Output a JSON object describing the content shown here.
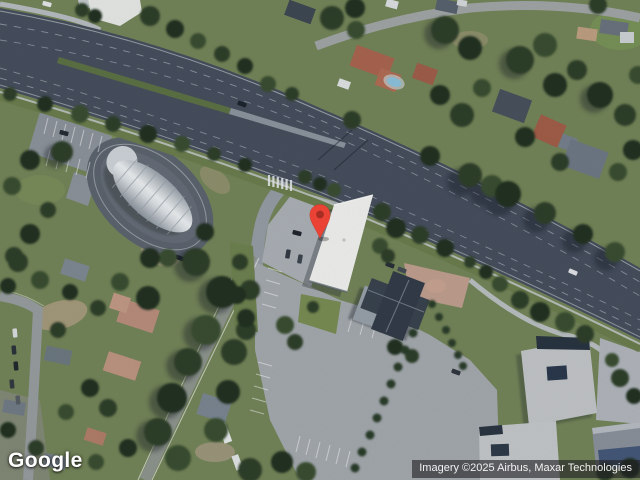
{
  "map": {
    "view_type": "satellite",
    "marker": {
      "icon": "map-pin-icon",
      "color": "#EA4335",
      "inner_color": "#9E2B22"
    },
    "palette": {
      "road_asphalt": "#47505f",
      "grass": "#75865a",
      "tree_canopy": "#2e4129",
      "parking_lot": "#a6abb0",
      "white_roof": "#f3f4f1",
      "hip_roof": "#39434f",
      "terracotta_roof": "#ab6651"
    }
  },
  "logo": {
    "text": "Google",
    "color": "#FFFFFF"
  },
  "attribution": {
    "text": "Imagery ©2025 Airbus, Maxar Technologies"
  }
}
